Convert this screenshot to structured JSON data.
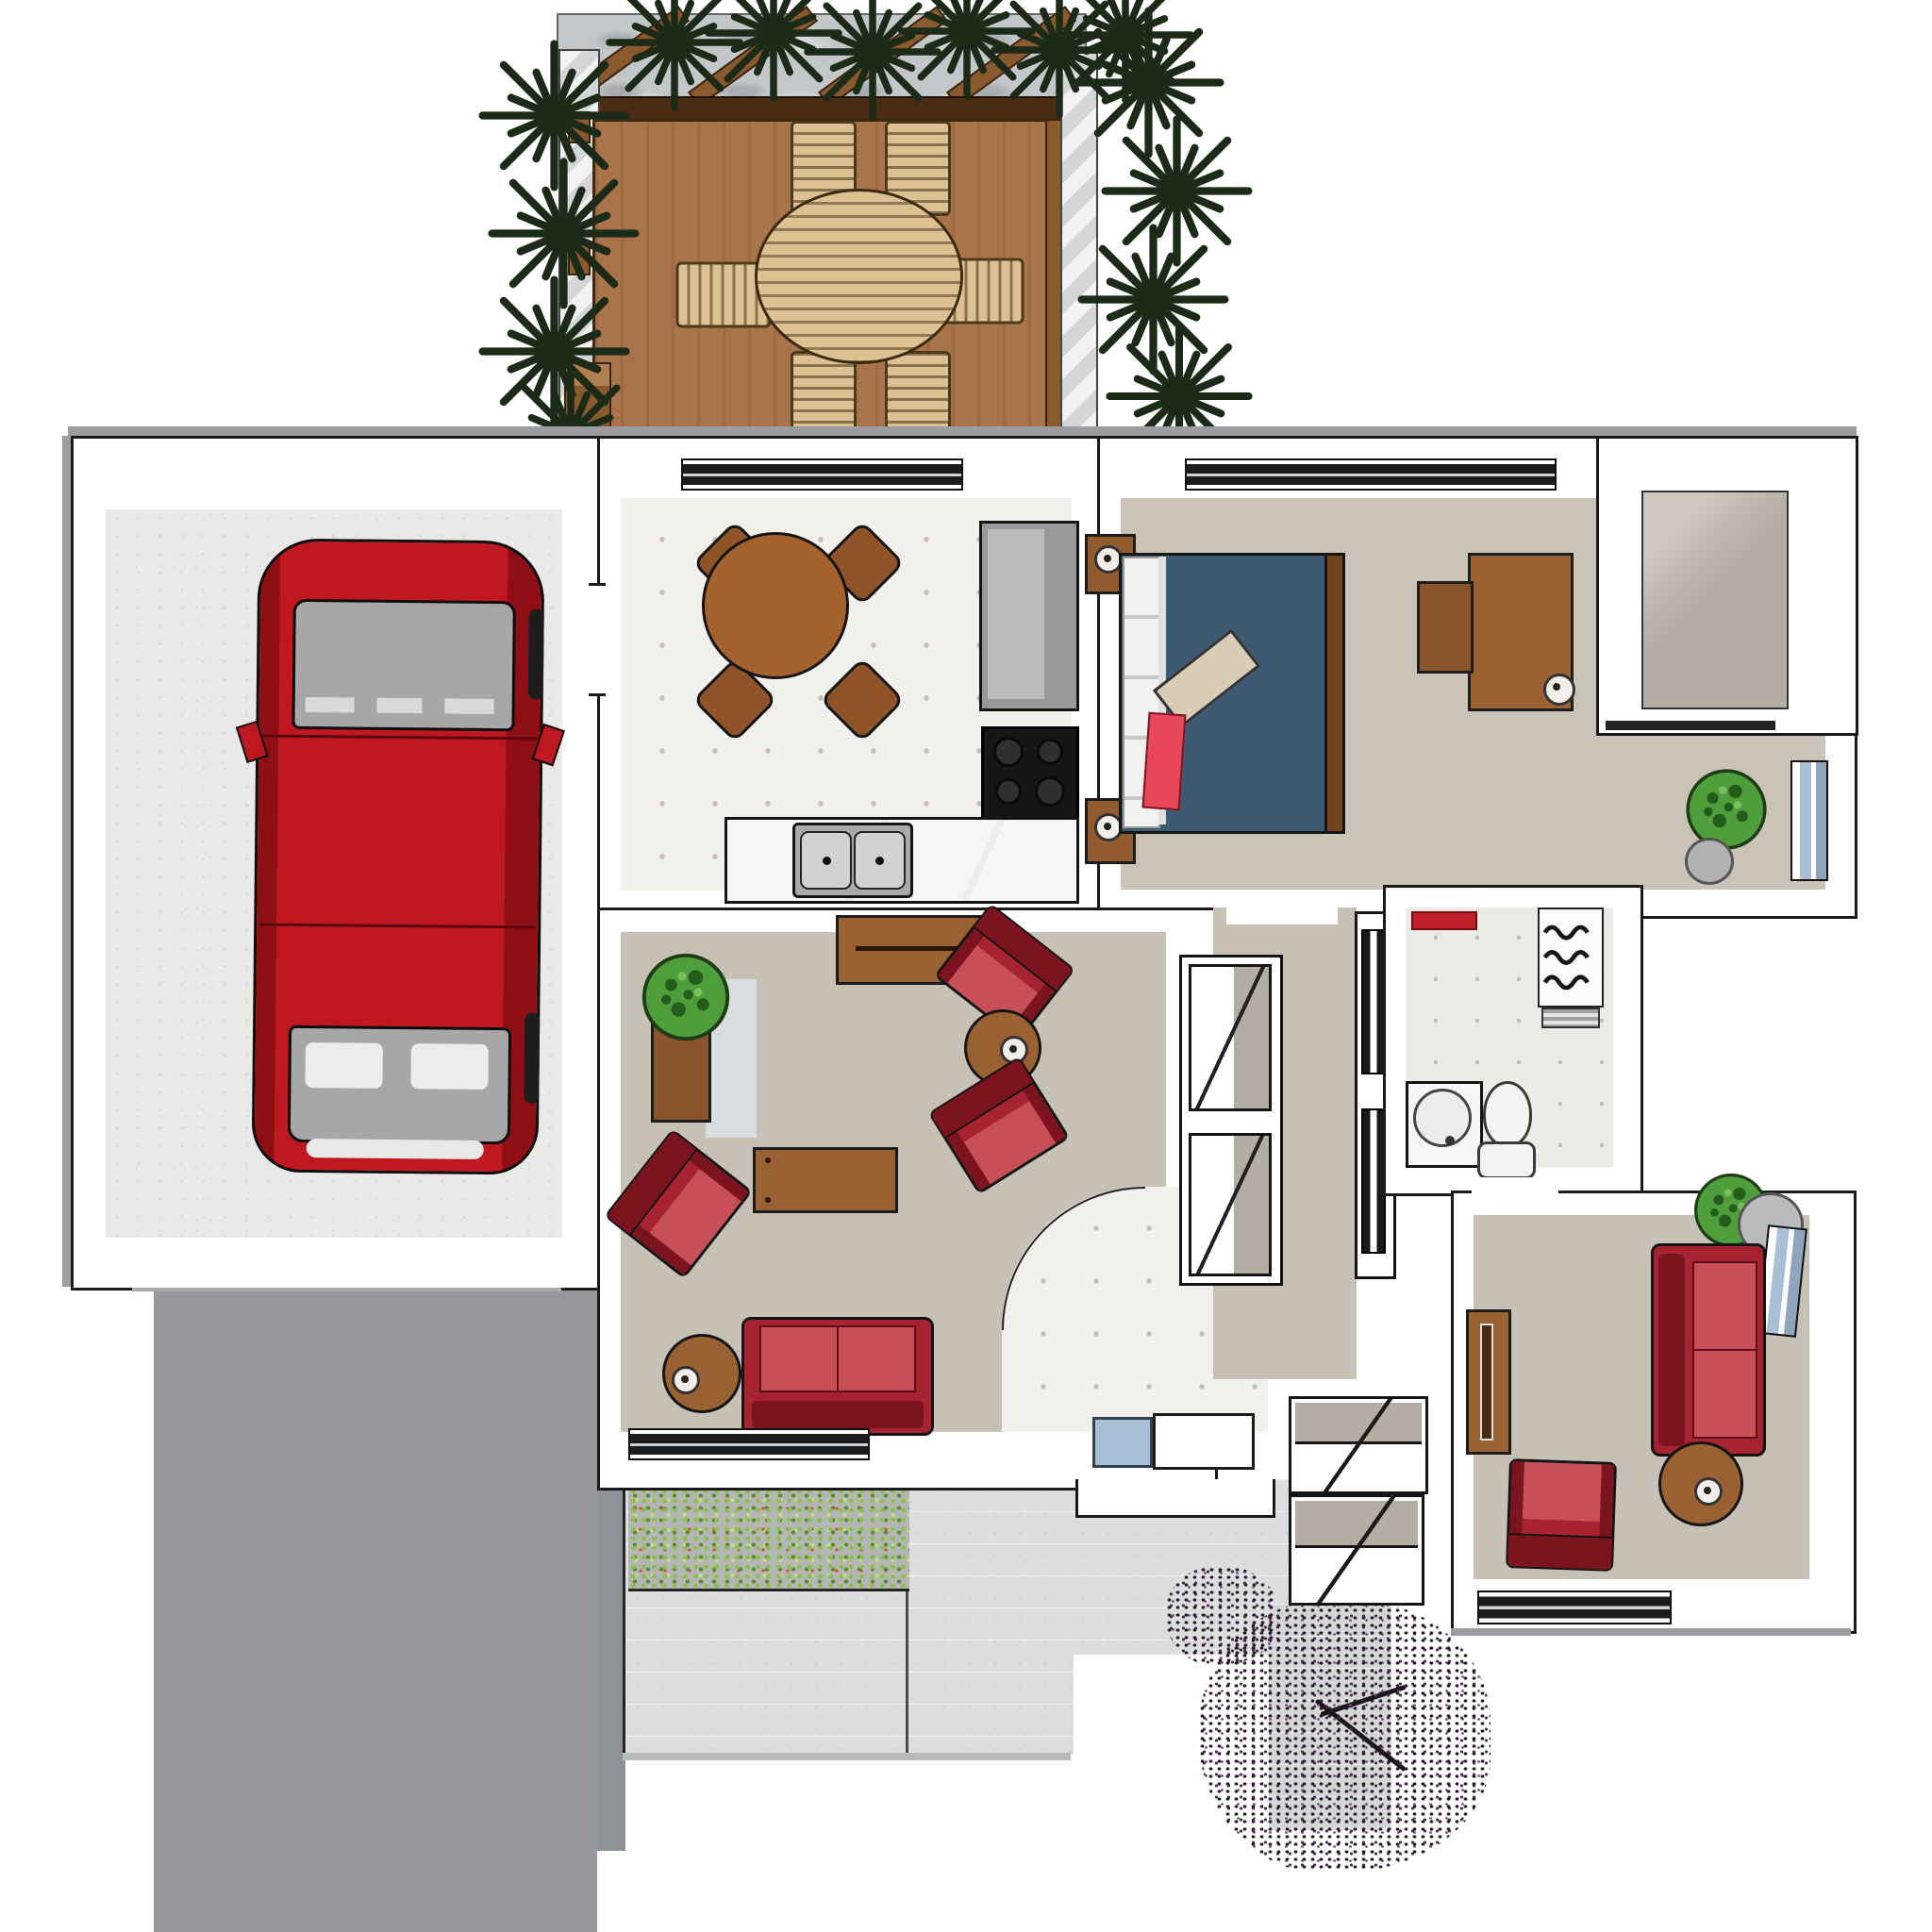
{
  "meta": {
    "kind": "3d-floor-plan-render",
    "visible_text": ""
  },
  "colors": {
    "wall": "#ffffff",
    "line": "#1a1a1a",
    "edge": "#9b9da0",
    "garage_floor": "#e9e9e7",
    "driveway": "#96989b",
    "kitchen_floor": "#f1f0ed",
    "tile_dot": "#c3bfb5",
    "carpet": "#c7c0b5",
    "bath_floor": "#eaeae6",
    "closet_floor": "#b3ada3",
    "pavement": "#dcdedd",
    "pavement_edge": "#8d9396",
    "deck_wood": "#a9744a",
    "deck_beam": "#4a2c12",
    "pergola_roof": "#c4c7c9",
    "pergola_post": "#8a5a2e",
    "outdoor_tan": "#dec193",
    "plant_dark": "#1c2b18",
    "plant_green": "#4f9e3c",
    "shrub_green": "#8abf4a",
    "shrub_red": "#d14d38",
    "tree_dark": "#261a28",
    "tree_purple": "#7a5280",
    "car_red": "#c01820",
    "car_dark": "#8e0f14",
    "car_glass": "#a7a7a7",
    "sofa_red": "#a82331",
    "sofa_dark": "#7c1420",
    "sofa_light": "#c84e58",
    "wood": "#9a6233",
    "wood_dark": "#6e4423",
    "bed_blue": "#3e5a72",
    "accent_red": "#e8475a",
    "pillow_beige": "#d8ccb4",
    "appliance": "#97999a",
    "stove": "#161616",
    "counter": "#f4f4f2",
    "steel": "#c7c9ca",
    "win_dark": "#1b1c1e",
    "win_blue": "#a9bfd6"
  },
  "scene": {
    "outdoor_areas": [
      "pergola-patio",
      "wood-deck",
      "hedge-plants",
      "flower-bed",
      "paved-patio",
      "driveway",
      "ornamental-tree"
    ],
    "rooms": [
      "garage",
      "kitchen",
      "bedroom",
      "walk-in-closet",
      "living-room",
      "hallway",
      "bathroom",
      "den"
    ],
    "furniture": {
      "pergola": [
        "outdoor-dining-table",
        "outdoor-chairs"
      ],
      "garage": [
        "red-car"
      ],
      "kitchen": [
        "round-dining-table",
        "four-chairs",
        "refrigerator",
        "stove",
        "counter-with-double-sink"
      ],
      "bedroom": [
        "double-bed",
        "nightstands",
        "desk",
        "desk-chair",
        "potted-plant",
        "window"
      ],
      "living_room": [
        "sideboard",
        "two-armchairs",
        "corner-armchair",
        "coffee-table",
        "side-tables",
        "sofa",
        "planter-plant"
      ],
      "bathroom": [
        "pedestal-sink",
        "toilet",
        "shower",
        "red-mat"
      ],
      "den": [
        "sofa",
        "armchair",
        "bookshelf",
        "side-table",
        "round-gray-table",
        "potted-plant"
      ]
    }
  }
}
